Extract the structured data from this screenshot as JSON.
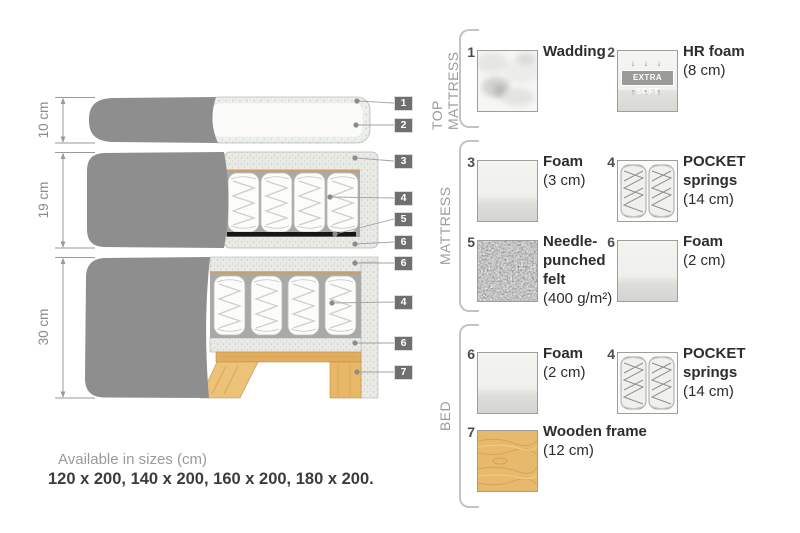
{
  "diagram": {
    "dimension_labels": [
      "10 cm",
      "19 cm",
      "30 cm"
    ],
    "callouts": [
      "1",
      "2",
      "3",
      "4",
      "5",
      "6",
      "6",
      "4",
      "6",
      "7"
    ]
  },
  "panel": {
    "sections": [
      {
        "title": "TOP MATTRESS",
        "items": [
          {
            "num": "1",
            "name": "Wadding",
            "detail": ""
          },
          {
            "num": "2",
            "name": "HR foam",
            "detail": "(8 cm)",
            "badge": "EXTRA SOFT",
            "arrows_down": "↓ ↓ ↓",
            "arrows_up": "↑ ↑ ↑"
          }
        ]
      },
      {
        "title": "MATTRESS",
        "items": [
          {
            "num": "3",
            "name": "Foam",
            "detail": "(3 cm)"
          },
          {
            "num": "4",
            "name": "POCKET springs",
            "detail": "(14 cm)"
          },
          {
            "num": "5",
            "name": "Needle-punched felt",
            "detail": "(400 g/m²)"
          },
          {
            "num": "6",
            "name": "Foam",
            "detail": "(2 cm)"
          }
        ]
      },
      {
        "title": "BED",
        "items": [
          {
            "num": "6",
            "name": "Foam",
            "detail": "(2 cm)"
          },
          {
            "num": "4",
            "name": "POCKET springs",
            "detail": "(14 cm)"
          },
          {
            "num": "7",
            "name": "Wooden frame",
            "detail": "(12 cm)"
          }
        ]
      }
    ]
  },
  "footer": {
    "line1": "Available in sizes (cm)",
    "line2": "120 x 200, 140 x 200, 160 x 200, 180 x 200."
  },
  "colors": {
    "fabric": "#8e8e8e",
    "foam_speckle": "#eaeae6",
    "wood": "#e5b56b",
    "felt": "#6e6e6e",
    "callout_chip": "#6f6f6f",
    "text_dark": "#2d2d2d",
    "text_gray": "#9a9a9a"
  }
}
